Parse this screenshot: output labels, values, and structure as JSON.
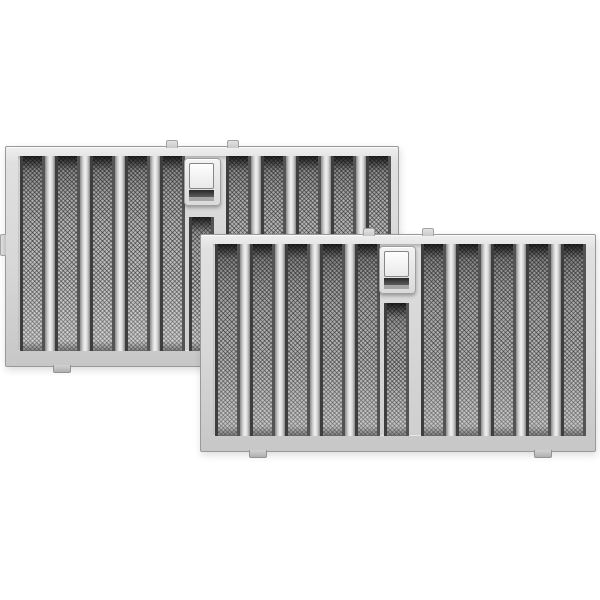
{
  "scene": {
    "type": "product-photo",
    "description": "Two identical stainless steel range hood baffle grease filters shown overlapping diagonally on a white background, each with vertical baffles over fine mesh, a spring latch handle at top center, and small mounting tabs on the edges",
    "background_color": "#ffffff",
    "item_count": 2
  },
  "product": {
    "name": "stainless-steel-baffle-filter-2-pack",
    "finish": "brushed stainless steel"
  },
  "palette": {
    "background": "#ffffff",
    "frame": "#d7d7d7",
    "frame_edge": "#999999",
    "ridge_highlight": "#f2f2f2",
    "mesh_base": "#b2b2b2",
    "slot_edge": "#3e3e3e",
    "handle_plate": "#dadada",
    "handle_button": "#e9e9e9",
    "latch_band": "#272727",
    "tab": "#c8c8c8"
  },
  "filters": [
    {
      "id": "rear-baffle-filter",
      "role": "rear",
      "x": 5,
      "y": 146,
      "width": 394,
      "height": 221,
      "rails": {
        "top": 10,
        "right": 6,
        "bottom": 14,
        "left": 13
      },
      "slots": {
        "slot_width": 25,
        "left_starts": [
          2,
          37,
          72,
          107,
          142
        ],
        "right_starts": [
          208,
          243,
          278,
          313,
          348
        ]
      },
      "handle": {
        "plate_x": 166,
        "plate_y": 2,
        "plate_w": 37,
        "plate_h": 48,
        "short_slot_x": 171,
        "short_slot_w": 25,
        "short_slot_top": 61
      },
      "tabs": {
        "top": [
          {
            "x": 160,
            "w": 12
          },
          {
            "x": 221,
            "w": 12
          }
        ],
        "bottom": [
          {
            "x": 47,
            "w": 18
          },
          {
            "x": 329,
            "w": 18
          }
        ],
        "side": [
          {
            "y": 87,
            "h": 22
          }
        ]
      }
    },
    {
      "id": "front-baffle-filter",
      "role": "front",
      "x": 200,
      "y": 234,
      "width": 396,
      "height": 218,
      "rails": {
        "top": 10,
        "right": 8,
        "bottom": 14,
        "left": 13
      },
      "slots": {
        "slot_width": 25,
        "left_starts": [
          2,
          37,
          72,
          107,
          142
        ],
        "right_starts": [
          208,
          243,
          278,
          313,
          348
        ]
      },
      "handle": {
        "plate_x": 166,
        "plate_y": 2,
        "plate_w": 37,
        "plate_h": 48,
        "short_slot_x": 171,
        "short_slot_w": 25,
        "short_slot_top": 59
      },
      "tabs": {
        "top": [
          {
            "x": 162,
            "w": 12
          },
          {
            "x": 221,
            "w": 12
          }
        ],
        "bottom": [
          {
            "x": 48,
            "w": 18
          },
          {
            "x": 333,
            "w": 18
          }
        ],
        "side": []
      }
    }
  ]
}
